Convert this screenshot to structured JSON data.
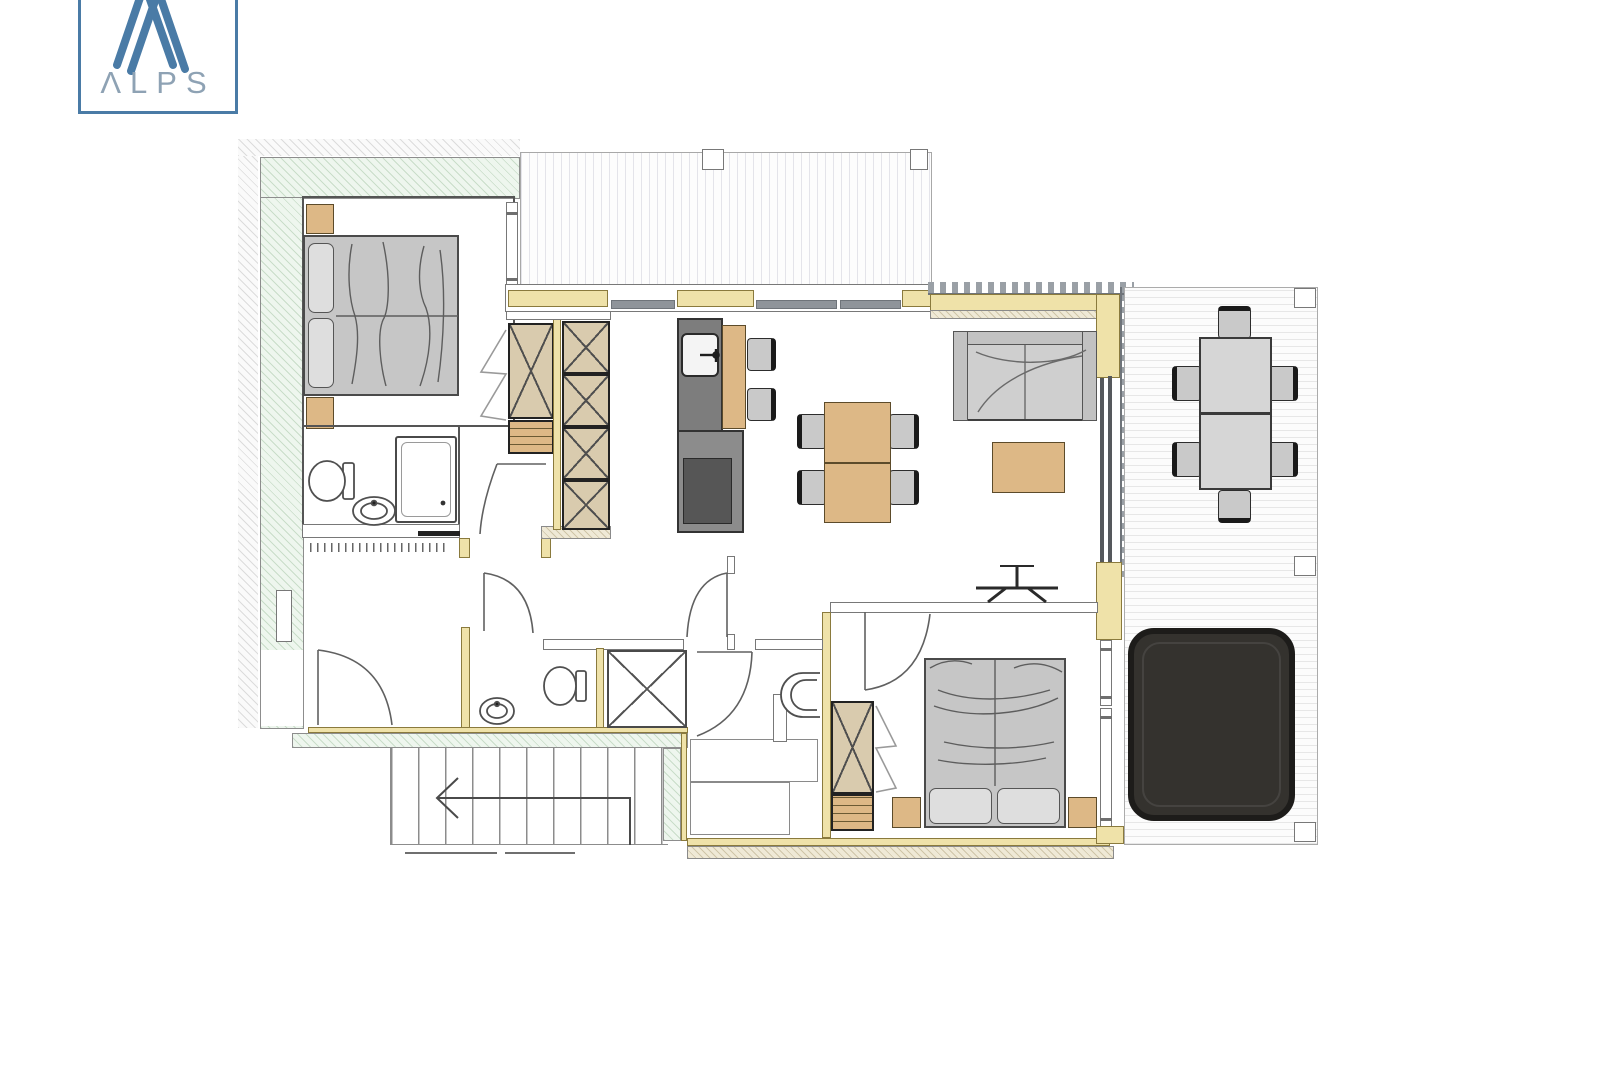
{
  "logo": {
    "text": "ΛLPS"
  },
  "colors": {
    "accent_blue": "#4a7ba6",
    "logo_text_color": "#8ea2b4",
    "wall_yellow": "#efe2a9",
    "furn_tan": "#ddb886",
    "furn_tan2": "#d9cbae",
    "bed_gray": "#c6c6c6",
    "pillow_gray": "#dedede",
    "kitchen_dark": "#7d7d7d",
    "oven_dark": "#565656",
    "hot_tub": "#34322e"
  },
  "plan": {
    "rooms": [
      "bedroom-1",
      "ensuite-bathroom",
      "hallway",
      "wc",
      "shower-room",
      "storage-room",
      "bedroom-2",
      "living-kitchen-room",
      "terrace",
      "upper-deck",
      "staircase"
    ],
    "furniture": [
      "double-bed-1",
      "double-bed-2",
      "wardrobes",
      "kitchen-block",
      "breakfast-bar",
      "dining-table-4-chairs",
      "sofa",
      "coffee-table",
      "tv",
      "outdoor-table-6-chairs",
      "hot-tub",
      "toilet",
      "shower",
      "washbasin"
    ]
  }
}
